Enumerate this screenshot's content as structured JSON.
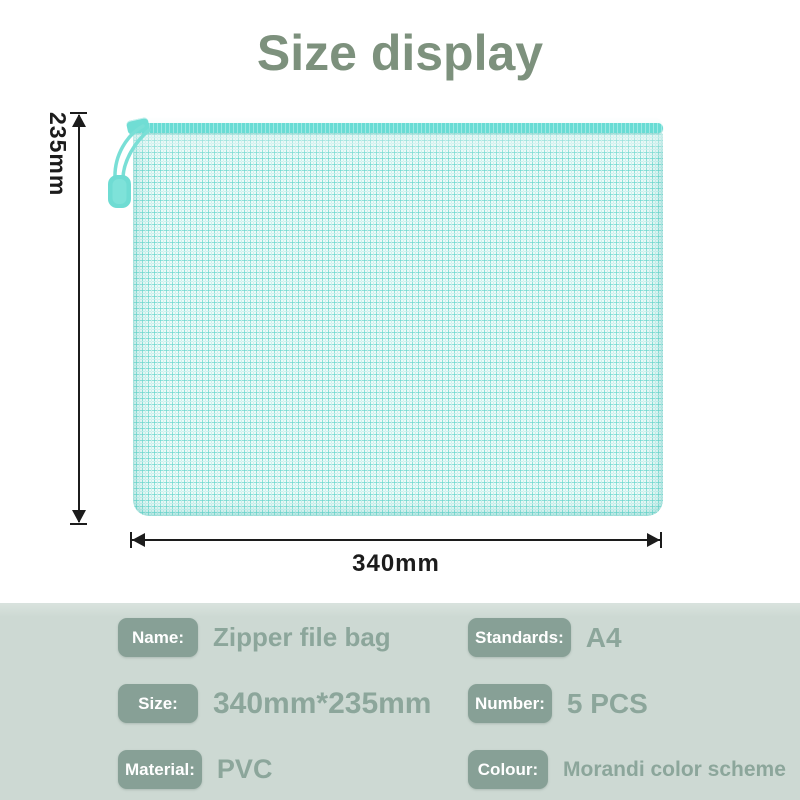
{
  "title": "Size display",
  "diagram": {
    "height_label": "235mm",
    "width_label": "340mm"
  },
  "bag": {
    "description": "mint mesh zipper file bag",
    "zipper_color": "#68dcd4",
    "mesh_line_color": "#6ad7ce",
    "pull_color": "#6fdcd3"
  },
  "specs": {
    "panel_bg": "#cdd9d3",
    "badge_color": "#87a096",
    "value_color": "#8ca69b",
    "items": [
      {
        "label": "Name:",
        "value": "Zipper file bag"
      },
      {
        "label": "Standards:",
        "value": "A4"
      },
      {
        "label": "Size:",
        "value": "340mm*235mm"
      },
      {
        "label": "Number:",
        "value": "5 PCS"
      },
      {
        "label": "Material:",
        "value": "PVC"
      },
      {
        "label": "Colour:",
        "value": "Morandi color scheme"
      }
    ]
  }
}
